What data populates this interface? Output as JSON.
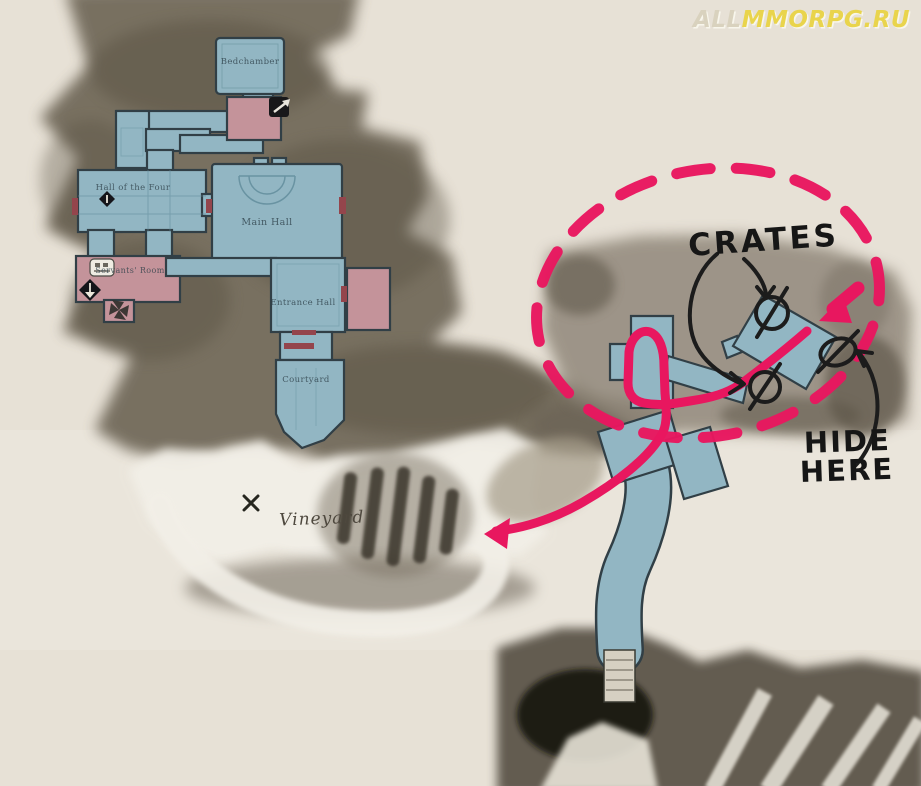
{
  "watermark": {
    "prefix": "ALL",
    "suffix": "MMORPG.RU"
  },
  "map": {
    "rooms": {
      "bedchamber": "Bedchamber",
      "hall_of_the_four": "Hall of the Four",
      "main_hall": "Main Hall",
      "servants_room": "Servants' Room",
      "entrance_hall": "Entrance Hall",
      "courtyard": "Courtyard"
    },
    "area_label": "Vineyard"
  },
  "annotations": {
    "crates": "CRATES",
    "hide": {
      "line1": "HIDE",
      "line2": "HERE"
    },
    "crate_marks_count": "3"
  },
  "legend_colors": {
    "route_pink": "#e8175f",
    "room_blue": "#92b6c3",
    "room_pink": "#c4939a",
    "terrain_dark": "#6b6355",
    "snow_white": "#f2efe7",
    "background_beige": "#e7e1d6",
    "ink_black": "#1c1c1c",
    "watermark_yellow": "#e9d44c"
  }
}
